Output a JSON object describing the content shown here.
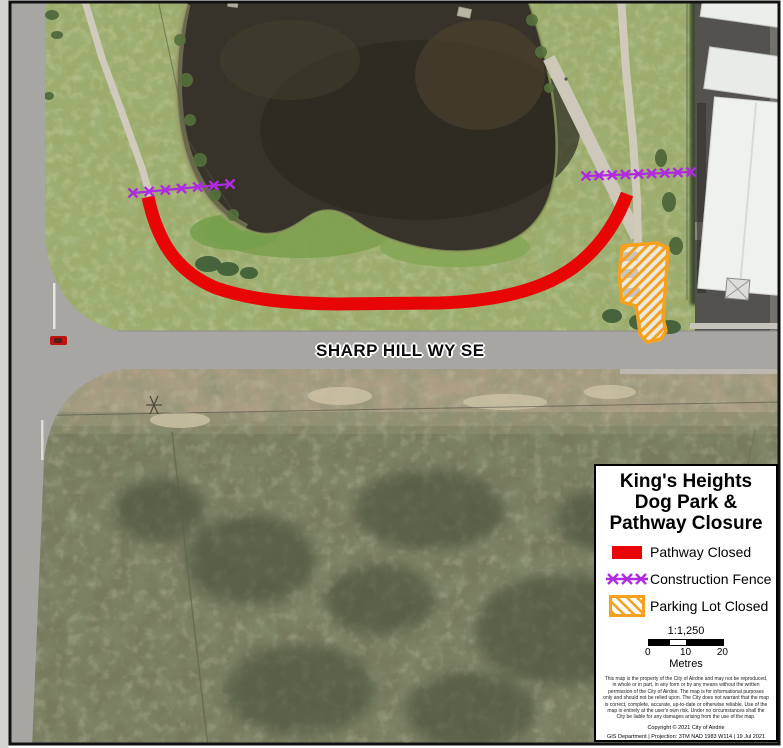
{
  "map": {
    "street_label": "SHARP HILL WY SE",
    "colors": {
      "pathway_closed": "#e80505",
      "construction_fence": "#ae2be0",
      "parking_outline": "#f5a01e"
    },
    "overlays": {
      "pathway_d": "M 148,197 C 158,244 178,272 216,288 C 252,300 285,303 335,304 L 440,303 C 498,301 543,290 574,267 C 598,249 616,224 627,194",
      "fences": [
        {
          "x1": 133,
          "y1": 193,
          "x2": 230,
          "y2": 184,
          "marks": 7
        },
        {
          "x1": 586,
          "y1": 176,
          "x2": 691,
          "y2": 172,
          "marks": 9
        }
      ],
      "parking_points": "622,246 657,243 668,248 666,280 663,318 666,331 661,339 647,342 640,334 638,318 636,306 622,302 619,276"
    }
  },
  "legend": {
    "title_lines": [
      "King's Heights",
      "Dog Park &",
      "Pathway Closure"
    ],
    "items": [
      {
        "symbol": "pathway-closed-swatch",
        "label": "Pathway Closed"
      },
      {
        "symbol": "construction-fence-swatch",
        "label": "Construction Fence"
      },
      {
        "symbol": "parking-lot-swatch",
        "label": "Parking Lot Closed"
      }
    ],
    "scale": {
      "ratio": "1:1,250",
      "ticks": [
        "0",
        "10",
        "20"
      ],
      "unit": "Metres"
    },
    "disclaimer": "This map is the property of the City of Airdrie and may not be reproduced, in whole or in part, in any form or by any means without the written permission of the City of Airdrie. The map is for informational purposes only and should not be relied upon. The City does not warrant that the map is correct, complete, accurate, up-to-date or otherwise reliable. Use of the map is entirely at the user's own risk. Under no circumstances shall the City be liable for any damages arising from the use of the map.",
    "copyright": "Copyright © 2021 City of Airdrie",
    "credits": "GIS Department | Projection: 3TM NAD 1983 W114 | 19 Jul 2021",
    "logo": {
      "city_of": "CITY OF",
      "name": "AIRDRIE",
      "tagline_left": "COMMUNITY &",
      "tagline_right": "OPPORTUNITY"
    }
  }
}
